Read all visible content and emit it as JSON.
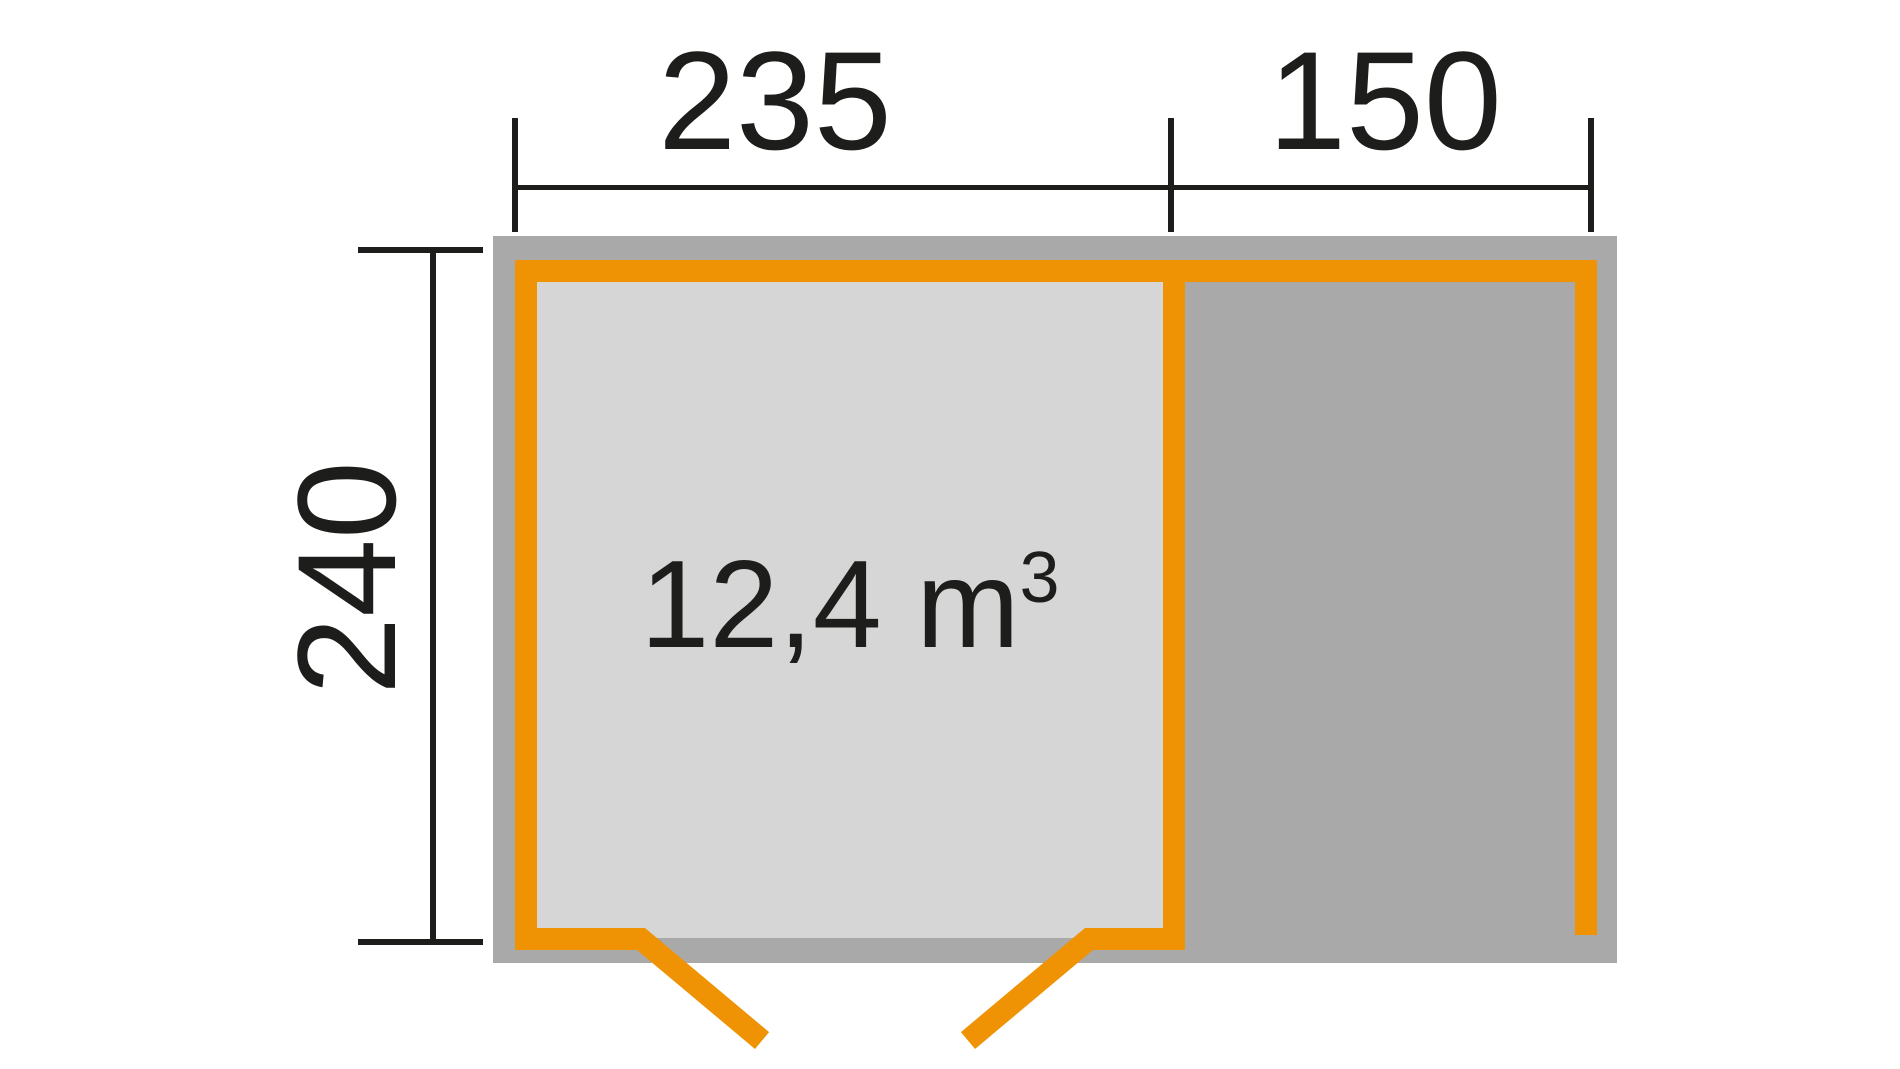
{
  "plan": {
    "width_main_cm": "235",
    "width_annex_cm": "150",
    "depth_cm": "240",
    "volume": {
      "value": "12,4 m",
      "exponent": "3"
    }
  },
  "colors": {
    "wall_accent": "#ef9305",
    "frame_gray": "#a9a9a9",
    "floor_light": "#d6d6d6",
    "dimension_ink": "#1d1d1b",
    "background": "#ffffff"
  }
}
